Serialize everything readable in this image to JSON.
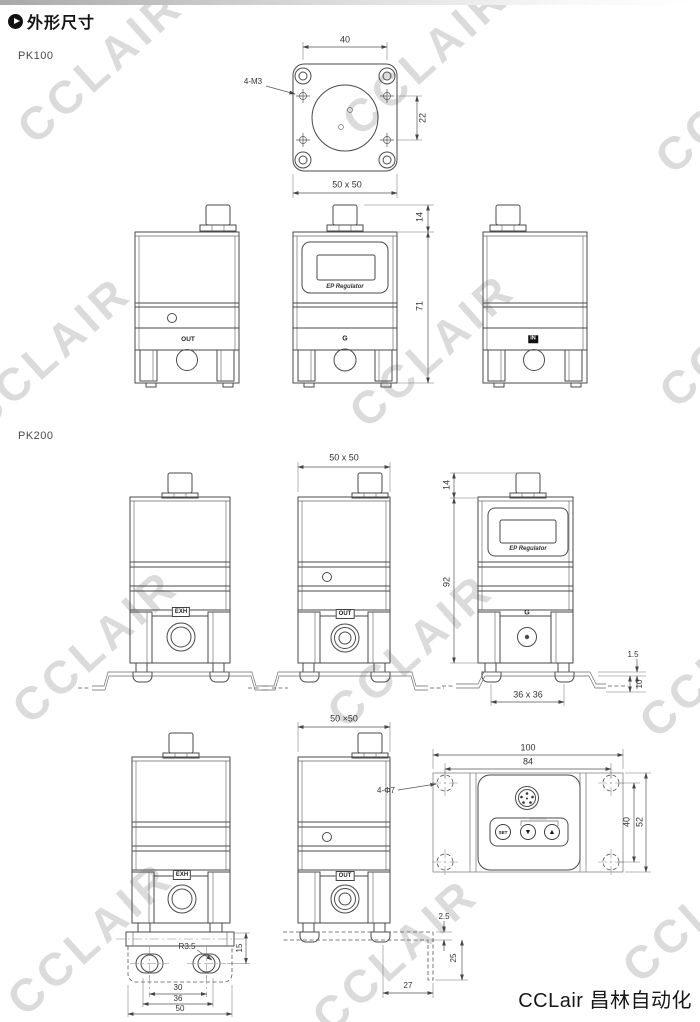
{
  "header": {
    "title": "外形尺寸"
  },
  "watermark": {
    "text": "CCLAIR"
  },
  "brand": {
    "text": "CCLair 昌林自动化"
  },
  "pk100": {
    "label": "PK100",
    "top_view": {
      "dim_width": "40",
      "dim_hole_spacing": "22",
      "dim_holes": "4-M3",
      "dim_footprint": "50 x 50"
    },
    "front_views": {
      "dim_connector_height": "14",
      "dim_body_height": "71",
      "port_left": "OUT",
      "port_front": "G",
      "port_right": "IN",
      "display_text": "EP Regulator"
    }
  },
  "pk200": {
    "label": "PK200",
    "row1": {
      "dim_footprint": "50 x 50",
      "dim_connector_height": "14",
      "dim_body_height": "92",
      "port_left": "EXH",
      "port_front": "OUT",
      "port_right": "G",
      "display_text": "EP Regulator",
      "dim_bracket_thickness": "1.5",
      "dim_bracket_height": "10",
      "dim_foot_span": "36 x 36"
    },
    "row2": {
      "dim_footprint": "50 ×50",
      "port_left": "EXH",
      "port_front": "OUT",
      "dim_slot_radius": "R3.5",
      "dim_slot_offset": "15",
      "dim_slot_spacing": "30",
      "dim_slot_outer": "36",
      "dim_plate_width": "50",
      "dim_bracket_thickness": "2.5",
      "dim_bracket_leg": "25",
      "dim_bracket_offset": "27"
    },
    "panel": {
      "dim_width": "100",
      "dim_hole_spacing_h": "84",
      "dim_holes": "4-Φ7",
      "dim_hole_spacing_v": "40",
      "dim_height": "52",
      "btn_set": "SET",
      "btn_down": "▼",
      "btn_up": "▲"
    }
  }
}
